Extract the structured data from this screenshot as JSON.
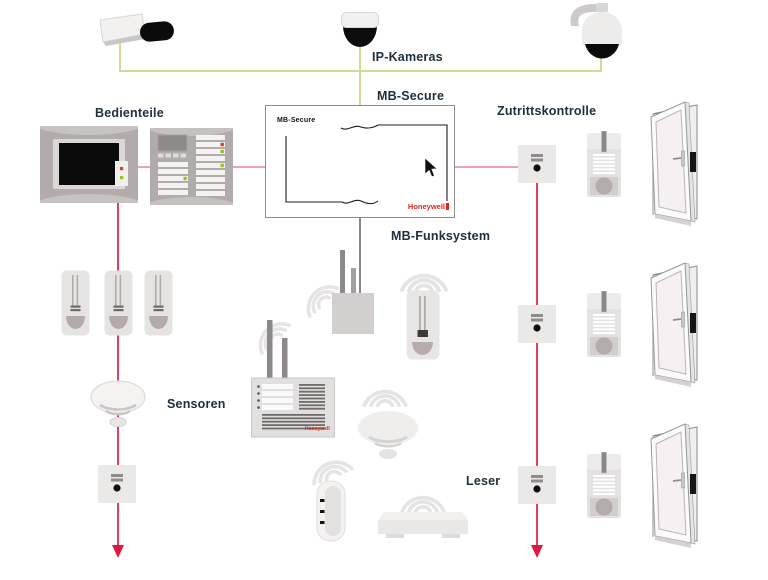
{
  "labels": {
    "ip_cameras": "IP-Kameras",
    "mb_secure": "MB-Secure",
    "bedienteile": "Bedienteile",
    "zutrittskontrolle": "Zutrittskontrolle",
    "mb_funksystem": "MB-Funksystem",
    "sensoren": "Sensoren",
    "leser": "Leser"
  },
  "central_unit": {
    "screen_title": "MB-Secure",
    "brand": "Honeywell"
  },
  "radio_panel": {
    "brand": "Honeywell"
  },
  "icons": {
    "bullet-camera-icon": "IP bullet camera",
    "dome-camera-icon": "IP dome camera",
    "ptz-camera-icon": "IP PTZ camera",
    "touch-panel-icon": "touch operating panel",
    "keypad-panel-icon": "LED keypad operating panel",
    "motion-sensor-icon": "PIR motion detector",
    "smoke-detector-icon": "smoke detector",
    "io-module-icon": "flush-mount reader/IO module",
    "radio-gateway-icon": "radio gateway with antennas",
    "radio-control-panel-icon": "radio control panel",
    "wireless-motion-sensor-icon": "wireless PIR detector",
    "wireless-smoke-detector-icon": "wireless smoke detector",
    "remote-fob-icon": "wireless remote fob",
    "wireless-reader-icon": "wireless flat reader",
    "card-reader-icon": "access-control card reader",
    "door-icon": "open door with frame",
    "wifi-waves-icon": "radio waves",
    "cursor-icon": "mouse pointer",
    "arrow-down-icon": "bus continuation arrow"
  },
  "colors": {
    "camera_bus": "#c6df92",
    "panel_bus": "#f0a0b8",
    "line_bus": "#dd3f66",
    "arrow": "#e0183f",
    "label_text": "#20303c",
    "brand_red": "#e2231a"
  }
}
